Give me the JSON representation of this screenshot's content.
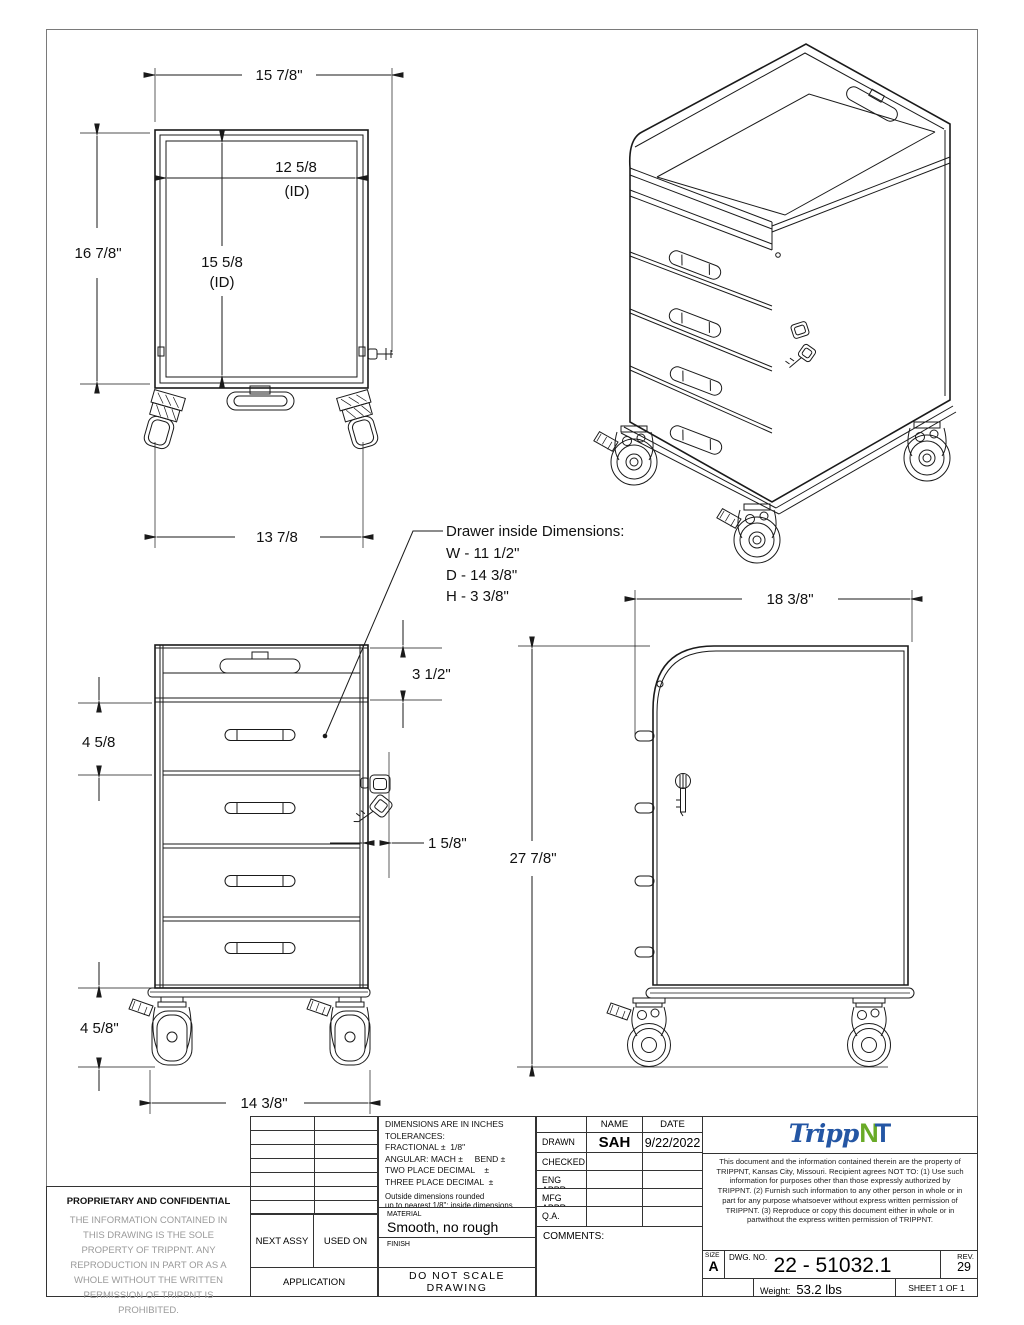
{
  "page": {
    "bg": "#ffffff",
    "line_color": "#1a1a1a",
    "border_color": "#7a7a7a"
  },
  "dims": {
    "back_width": "15 7/8\"",
    "back_height": "16 7/8\"",
    "back_inner_width": "12 5/8",
    "back_inner_width_note": "(ID)",
    "back_inner_height": "15 5/8",
    "back_inner_height_note": "(ID)",
    "back_base_width": "13 7/8",
    "front_tray_height": "3 1/2\"",
    "front_drawer_pitch": "4 5/8",
    "front_lock_offset": "1 5/8\"",
    "front_caster_height": "4 5/8\"",
    "front_base_width": "14 3/8\"",
    "side_depth": "18 3/8\"",
    "side_height": "27 7/8\""
  },
  "callout": {
    "title": "Drawer inside Dimensions:",
    "width": "W - 11 1/2\"",
    "depth": "D - 14 3/8\"",
    "height": "H - 3 3/8\""
  },
  "title_block": {
    "tolerance_lines": [
      "DIMENSIONS ARE IN INCHES",
      "TOLERANCES:",
      "FRACTIONAL ±  1/8\"",
      "ANGULAR: MACH ±     BEND ±",
      "TWO PLACE DECIMAL    ±",
      "THREE PLACE DECIMAL  ±"
    ],
    "rounding_lines": [
      "Outside dimensions rounded",
      "up to nearest 1/8\"; inside dimensions",
      "rounded down to nearest 1/8\""
    ],
    "material_label": "MATERIAL",
    "material_value": "Smooth, no rough edges",
    "finish_label": "FINISH",
    "do_not_scale": "DO  NOT  SCALE  DRAWING",
    "next_assy": "NEXT ASSY",
    "used_on": "USED ON",
    "application": "APPLICATION",
    "name_header": "NAME",
    "date_header": "DATE",
    "approval_rows": [
      {
        "label": "DRAWN",
        "name": "SAH",
        "date": "9/22/2022"
      },
      {
        "label": "CHECKED",
        "name": "",
        "date": ""
      },
      {
        "label": "ENG APPR.",
        "name": "",
        "date": ""
      },
      {
        "label": "MFG APPR.",
        "name": "",
        "date": ""
      },
      {
        "label": "Q.A.",
        "name": "",
        "date": ""
      }
    ],
    "comments_label": "COMMENTS:",
    "proprietary_title": "PROPRIETARY AND CONFIDENTIAL",
    "proprietary_body": "THE INFORMATION CONTAINED IN THIS DRAWING IS THE SOLE PROPERTY OF TRIPPNT.  ANY REPRODUCTION IN PART OR AS A WHOLE WITHOUT THE WRITTEN PERMISSION OF TRIPPNT IS PROHIBITED.",
    "legal_notice": "This document and the information contained therein are the property of TRIPPNT, Kansas City, Missouri. Recipient agrees NOT TO: (1) Use such information for purposes other than those expressly authorized by TRIPPNT. (2) Furnish such information to any other person in whole or in part for any purpose whatsoever without express  written permission of TRIPPNT. (3) Reproduce or copy this document either in whole or in partwithout the express written permission of TRIPPNT.",
    "logo": {
      "script": "Tripp",
      "n": "N",
      "t": "T",
      "blue": "#2456a4",
      "green": "#69aa27"
    },
    "size_label": "SIZE",
    "size_value": "A",
    "dwg_label": "DWG.  NO.",
    "dwg_value": "22 - 51032.1",
    "rev_label": "REV.",
    "rev_value": "29",
    "weight_label": "Weight:",
    "weight_value": "53.2 lbs",
    "sheet_label": "SHEET 1 OF 1"
  }
}
